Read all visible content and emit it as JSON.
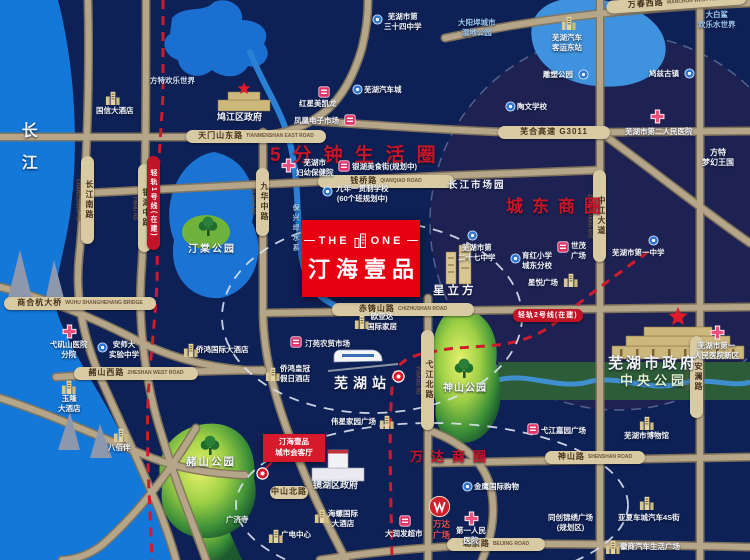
{
  "map": {
    "colors": {
      "background": "#0e2156",
      "water": "#1478d8",
      "road": "#b6a689",
      "capsule": "#d8cba4",
      "accent_red": "#c81528",
      "project_red": "#e60012",
      "metro_red": "#c21426",
      "park_green": "#8cc63f"
    },
    "project": {
      "logo_left": "THE",
      "logo_right": "ONE",
      "name": "汀海壹品"
    },
    "flag": {
      "lines": [
        "汀海壹品",
        "城市会客厅"
      ]
    },
    "pois": [
      {
        "n": "changjiang-river-label",
        "k": "lbl",
        "t": "长江",
        "x": 16,
        "y": 122,
        "s": 16,
        "ls": 16,
        "v": true,
        "c": "#eaf4ff"
      },
      {
        "n": "shanghehang-bridge-capsule",
        "k": "cap",
        "t": "商合杭大桥",
        "en": "WUHU SHANGHEHANG BRIDGE",
        "x": 4,
        "y": 297,
        "w": 152
      },
      {
        "n": "tianmenshan-east-road-capsule",
        "k": "cap",
        "t": "天门山东路",
        "en": "TIANMENSHAN EAST ROAD",
        "x": 186,
        "y": 130,
        "w": 140
      },
      {
        "n": "wanchun-west-road-capsule",
        "k": "cap",
        "t": "万春西路",
        "en": "WANCHUN WEST ROAD",
        "x": 606,
        "y": 1,
        "w": 140,
        "rot": -4
      },
      {
        "n": "qianqiao-road-capsule",
        "k": "cap",
        "t": "钱桥路",
        "en": "QIANQIAO ROAD",
        "x": 318,
        "y": 175,
        "w": 136
      },
      {
        "n": "chizhushan-road-capsule",
        "k": "cap",
        "t": "赤铸山路",
        "en": "CHIZHUSHAN ROAD",
        "x": 332,
        "y": 303,
        "w": 142
      },
      {
        "n": "zheshan-west-road-capsule",
        "k": "cap",
        "t": "赭山西路",
        "en": "ZHESHAN WEST ROAD",
        "x": 74,
        "y": 367,
        "w": 124
      },
      {
        "n": "shenshan-road-capsule",
        "k": "cap",
        "t": "神山路",
        "en": "SHENSHAN ROAD",
        "x": 545,
        "y": 451,
        "w": 100
      },
      {
        "n": "beijing-road-capsule",
        "k": "cap",
        "t": "北京路",
        "en": "BEIJING ROAD",
        "x": 447,
        "y": 538,
        "w": 98
      },
      {
        "n": "wuhe-expressway-capsule",
        "k": "cap",
        "t": "芜合高速 G3011",
        "x": 498,
        "y": 126,
        "w": 112
      },
      {
        "n": "zhongshan-north-road-capsule",
        "k": "cap",
        "t": "中山北路",
        "x": 270,
        "y": 486,
        "w": 38
      },
      {
        "n": "changjiang-south-road-capsule",
        "k": "capv",
        "t": "长江南路",
        "en": "CHANGJIANG RD",
        "x": 81,
        "y": 156,
        "h": 88
      },
      {
        "n": "yinhu-middle-road-capsule",
        "k": "capv",
        "t": "银湖中路",
        "en": "YINHU RD",
        "x": 138,
        "y": 164,
        "h": 88
      },
      {
        "n": "jiuhua-middle-road-capsule",
        "k": "capv",
        "t": "九华中路",
        "en": "JIUHUA RD",
        "x": 256,
        "y": 168,
        "h": 68
      },
      {
        "n": "zhongjiang-avenue-capsule",
        "k": "capv",
        "t": "中江大道",
        "en": "ZHONGJIANG AVE",
        "x": 593,
        "y": 170,
        "h": 92
      },
      {
        "n": "yijiang-north-road-capsule",
        "k": "capv",
        "t": "弋江北路",
        "en": "YIJIANG RD",
        "x": 421,
        "y": 330,
        "h": 100
      },
      {
        "n": "anlan-road-capsule",
        "k": "capv",
        "t": "安澜路",
        "en": "ANLAN RD",
        "x": 690,
        "y": 336,
        "h": 82
      },
      {
        "n": "metro-line1-capsule",
        "k": "metv",
        "t": "轻轨1号线(在建)",
        "x": 147,
        "y": 156,
        "h": 94
      },
      {
        "n": "metro-line2-capsule",
        "k": "met",
        "t": "轻轨2号线(在建)",
        "x": 513,
        "y": 309
      },
      {
        "n": "five-min-life-circle-label",
        "k": "lbl",
        "t": "5分钟生活圈",
        "x": 270,
        "y": 144,
        "s": 19,
        "c": "#c81528",
        "ls": 12
      },
      {
        "n": "chengdong-business-circle-label",
        "k": "lbl",
        "t": "城东商圈",
        "x": 506,
        "y": 196,
        "s": 17,
        "c": "#c81528",
        "ls": 9
      },
      {
        "n": "wanda-business-circle-label",
        "k": "lbl",
        "t": "万达商圈",
        "x": 410,
        "y": 449,
        "s": 13,
        "c": "#c81528",
        "ls": 8
      },
      {
        "n": "jiujiang-district-gov-label",
        "k": "lbl",
        "t": "鸠江区政府",
        "x": 217,
        "y": 112,
        "s": 9
      },
      {
        "n": "fantawild-adventure-label",
        "k": "lbl",
        "t": "方特欢乐世界",
        "x": 150,
        "y": 76,
        "s": 7.5,
        "c": "#cfe0f5"
      },
      {
        "n": "guoxin-hotel-label",
        "k": "lbl",
        "t": "国信大酒店",
        "x": 96,
        "y": 106,
        "s": 7.5
      },
      {
        "n": "guoxin-hotel-icon",
        "k": "bldg",
        "x": 104,
        "y": 88
      },
      {
        "n": "redstar-macalline-label",
        "k": "lbl",
        "t": "红星美凯龙",
        "x": 299,
        "y": 99,
        "s": 7.5
      },
      {
        "n": "redstar-macalline-icon",
        "k": "mkt",
        "x": 318,
        "y": 86
      },
      {
        "n": "phoenix-electronics-market-label",
        "k": "lbl",
        "t": "凤凰电子市场",
        "x": 294,
        "y": 116,
        "s": 7.5
      },
      {
        "n": "phoenix-electronics-market-icon",
        "k": "mkt",
        "x": 344,
        "y": 114
      },
      {
        "n": "wuhu-auto-city-label",
        "k": "lbl",
        "t": "芜湖汽车城",
        "x": 364,
        "y": 85,
        "s": 7.5
      },
      {
        "n": "wuhu-auto-city-icon",
        "k": "badge",
        "x": 352,
        "y": 84
      },
      {
        "n": "no34-middle-school-label",
        "k": "lbl",
        "t": [
          "芜湖市第",
          "三十四中学"
        ],
        "x": 384,
        "y": 12,
        "s": 7.5
      },
      {
        "n": "no34-middle-school-icon",
        "k": "badge",
        "x": 372,
        "y": 14
      },
      {
        "n": "dayanghan-wetland-park-label",
        "k": "lbl",
        "t": [
          "大阳垾城市",
          "湿地公园"
        ],
        "x": 458,
        "y": 18,
        "s": 7.5,
        "c": "#9dc8f0"
      },
      {
        "n": "white-shark-water-park-label",
        "k": "lbl",
        "t": [
          "大白鲨",
          "欢乐水世界"
        ],
        "x": 698,
        "y": 10,
        "s": 7.5,
        "c": "#9dc8f0"
      },
      {
        "n": "coach-east-station-label",
        "k": "lbl",
        "t": [
          "芜湖汽车",
          "客运东站"
        ],
        "x": 552,
        "y": 33,
        "s": 7.5
      },
      {
        "n": "coach-east-station-icon",
        "k": "bldg",
        "x": 560,
        "y": 13
      },
      {
        "n": "sculpture-park-label",
        "k": "lbl",
        "t": "雕塑公园",
        "x": 543,
        "y": 70,
        "s": 7.5
      },
      {
        "n": "sculpture-park-icon",
        "k": "badge",
        "x": 578,
        "y": 69
      },
      {
        "n": "jiuzi-ancient-town-label",
        "k": "lbl",
        "t": "鸠兹古镇",
        "x": 649,
        "y": 69,
        "s": 7.5
      },
      {
        "n": "jiuzi-ancient-town-icon",
        "k": "badge",
        "x": 684,
        "y": 68
      },
      {
        "n": "taowen-school-label",
        "k": "lbl",
        "t": "陶文学校",
        "x": 517,
        "y": 102,
        "s": 7.5
      },
      {
        "n": "taowen-school-icon",
        "k": "badge",
        "x": 505,
        "y": 101
      },
      {
        "n": "no2-peoples-hospital-label",
        "k": "lbl",
        "t": "芜湖市第二人民医院",
        "x": 625,
        "y": 127,
        "s": 7.5
      },
      {
        "n": "no2-peoples-hospital-icon",
        "k": "cross",
        "x": 650,
        "y": 109
      },
      {
        "n": "fuyou-hospital-label",
        "k": "lbl",
        "t": [
          "芜湖市",
          "妇幼保健院"
        ],
        "x": 296,
        "y": 158,
        "s": 7.5
      },
      {
        "n": "fuyou-hospital-icon",
        "k": "cross",
        "x": 281,
        "y": 158
      },
      {
        "n": "yinhu-food-street-label",
        "k": "lbl",
        "t": "银湖美食街(规划中)",
        "x": 352,
        "y": 162,
        "s": 7.5
      },
      {
        "n": "yinhu-food-street-icon",
        "k": "mkt",
        "x": 338,
        "y": 160
      },
      {
        "n": "nine-year-school-label",
        "k": "lbl",
        "t": [
          "九年一贯制学校",
          "(60个班规划中)"
        ],
        "x": 336,
        "y": 184,
        "s": 7.5
      },
      {
        "n": "nine-year-school-icon",
        "k": "badge",
        "x": 322,
        "y": 186
      },
      {
        "n": "baoxinghan-water-label",
        "k": "lbl",
        "t": "保兴垾水系",
        "x": 291,
        "y": 204,
        "s": 7,
        "c": "#a8cdf0",
        "v": true,
        "ls": 3
      },
      {
        "n": "changjiang-market-park-label",
        "k": "lbl",
        "t": "长江市场园",
        "x": 448,
        "y": 180,
        "s": 9.5,
        "ls": 2
      },
      {
        "n": "no27-middle-school-label",
        "k": "lbl",
        "t": [
          "芜湖市第",
          "二十七中学"
        ],
        "x": 458,
        "y": 243,
        "s": 7.5
      },
      {
        "n": "no27-middle-school-icon",
        "k": "badge",
        "x": 467,
        "y": 230
      },
      {
        "n": "xinglifang-label",
        "k": "lbl",
        "t": "星立方",
        "x": 433,
        "y": 284,
        "s": 11.5,
        "ls": 3
      },
      {
        "n": "fantawild-dream-kingdom-label",
        "k": "lbl",
        "t": [
          "方特",
          "梦幻王国"
        ],
        "x": 702,
        "y": 148,
        "s": 8
      },
      {
        "n": "shimao-plaza-label",
        "k": "lbl",
        "t": [
          "世茂",
          "广场"
        ],
        "x": 571,
        "y": 241,
        "s": 7.5
      },
      {
        "n": "shimao-plaza-icon",
        "k": "mkt",
        "x": 557,
        "y": 241
      },
      {
        "n": "no1-middle-school-label",
        "k": "lbl",
        "t": "芜湖市第一中学",
        "x": 612,
        "y": 248,
        "s": 7.5
      },
      {
        "n": "no1-middle-school-icon",
        "k": "badge",
        "x": 648,
        "y": 235
      },
      {
        "n": "yuhong-primary-school-label",
        "k": "lbl",
        "t": [
          "育红小学",
          "城东分校"
        ],
        "x": 522,
        "y": 251,
        "s": 7.5
      },
      {
        "n": "yuhong-primary-school-icon",
        "k": "badge",
        "x": 510,
        "y": 253
      },
      {
        "n": "xingyue-plaza-label",
        "k": "lbl",
        "t": "星悦广场",
        "x": 528,
        "y": 278,
        "s": 7.5
      },
      {
        "n": "xingyue-plaza-icon",
        "k": "bldg",
        "x": 562,
        "y": 270
      },
      {
        "n": "no1-peoples-hospital-label",
        "k": "lbl",
        "t": [
          "芜湖市第一",
          "人民医院新区"
        ],
        "x": 694,
        "y": 341,
        "s": 7.5
      },
      {
        "n": "no1-peoples-hospital-icon",
        "k": "cross",
        "x": 710,
        "y": 325
      },
      {
        "n": "tingyuan-market-label",
        "k": "lbl",
        "t": "汀苑农贸市场",
        "x": 305,
        "y": 339,
        "s": 7.5
      },
      {
        "n": "tingyuan-market-icon",
        "k": "mkt",
        "x": 290,
        "y": 336
      },
      {
        "n": "oyada-home-label",
        "k": "lbl",
        "t": [
          "欧亚达",
          "国际家居"
        ],
        "x": 367,
        "y": 312,
        "s": 7.5
      },
      {
        "n": "oyada-home-icon",
        "k": "bldg",
        "x": 353,
        "y": 312
      },
      {
        "n": "crowne-plaza-hotel-label",
        "k": "lbl",
        "t": [
          "侨鸿皇冠",
          "假日酒店"
        ],
        "x": 280,
        "y": 364,
        "s": 7.5
      },
      {
        "n": "crowne-plaza-hotel-icon",
        "k": "bldg",
        "x": 264,
        "y": 364
      },
      {
        "n": "wuhu-station-label",
        "k": "lbl",
        "t": "芜湖站",
        "x": 334,
        "y": 374,
        "s": 14,
        "ls": 5
      },
      {
        "n": "wuhu-station-metro-icon",
        "k": "dot",
        "x": 392,
        "y": 370
      },
      {
        "n": "qiaohong-intl-hotel-label",
        "k": "lbl",
        "t": "侨鸿国际大酒店",
        "x": 196,
        "y": 345,
        "s": 7.5
      },
      {
        "n": "qiaohong-intl-hotel-icon",
        "k": "bldg",
        "x": 182,
        "y": 340
      },
      {
        "n": "yijishan-hospital-label",
        "k": "lbl",
        "t": [
          "弋矶山医院",
          "分院"
        ],
        "x": 50,
        "y": 340,
        "s": 7.5
      },
      {
        "n": "yijishan-hospital-icon",
        "k": "cross",
        "x": 62,
        "y": 324
      },
      {
        "n": "anshida-school-label",
        "k": "lbl",
        "t": [
          "安师大",
          "实验中学"
        ],
        "x": 109,
        "y": 340,
        "s": 7.5
      },
      {
        "n": "anshida-school-icon",
        "k": "badge",
        "x": 97,
        "y": 342
      },
      {
        "n": "yulong-hotel-label",
        "k": "lbl",
        "t": [
          "玉隆",
          "大酒店"
        ],
        "x": 58,
        "y": 394,
        "s": 7.5
      },
      {
        "n": "yulong-hotel-icon",
        "k": "bldg",
        "x": 60,
        "y": 377
      },
      {
        "n": "weixing-plaza-label",
        "k": "lbl",
        "t": "伟星家园广场",
        "x": 331,
        "y": 417,
        "s": 7.5
      },
      {
        "n": "weixing-plaza-icon",
        "k": "bldg",
        "x": 378,
        "y": 412
      },
      {
        "n": "tingtang-park-label",
        "k": "lbl",
        "t": "汀棠公园",
        "x": 188,
        "y": 243,
        "s": 10,
        "ls": 2
      },
      {
        "n": "tingtang-park-tree-icon",
        "k": "tree",
        "x": 196,
        "y": 216
      },
      {
        "n": "zheshan-park-label",
        "k": "lbl",
        "t": "赭山公园",
        "x": 186,
        "y": 456,
        "s": 10.5,
        "ls": 2
      },
      {
        "n": "zheshan-park-tree-icon",
        "k": "tree",
        "x": 198,
        "y": 435
      },
      {
        "n": "shenshan-park-label",
        "k": "lbl",
        "t": "神山公园",
        "x": 443,
        "y": 382,
        "s": 10,
        "ls": 1
      },
      {
        "n": "shenshan-park-tree-icon",
        "k": "tree",
        "x": 452,
        "y": 358
      },
      {
        "n": "baibaiban-label",
        "k": "lbl",
        "t": "八佰伴",
        "x": 108,
        "y": 443,
        "s": 7.5
      },
      {
        "n": "baibaiban-icon",
        "k": "bldg",
        "x": 112,
        "y": 425
      },
      {
        "n": "guangjisi-temple-label",
        "k": "lbl",
        "t": "广济寺",
        "x": 226,
        "y": 515,
        "s": 7.5
      },
      {
        "n": "jinghu-district-gov-label",
        "k": "lbl",
        "t": "镜湖区政府",
        "x": 313,
        "y": 480,
        "s": 9
      },
      {
        "n": "conch-intl-hotel-label",
        "k": "lbl",
        "t": [
          "海螺国际",
          "大酒店"
        ],
        "x": 328,
        "y": 509,
        "s": 7.5
      },
      {
        "n": "conch-intl-hotel-icon",
        "k": "bldg",
        "x": 313,
        "y": 506
      },
      {
        "n": "radio-tv-center-label",
        "k": "lbl",
        "t": "广电中心",
        "x": 281,
        "y": 530,
        "s": 7.5
      },
      {
        "n": "radio-tv-center-icon",
        "k": "bldg",
        "x": 267,
        "y": 526
      },
      {
        "n": "wanda-plaza-label",
        "k": "lbl",
        "t": [
          "万达",
          "广场"
        ],
        "x": 433,
        "y": 519,
        "s": 8.5,
        "c": "#e65252"
      },
      {
        "n": "wanda-plaza-icon",
        "k": "wanda",
        "x": 428,
        "y": 495
      },
      {
        "n": "no1-hospital-label",
        "k": "lbl",
        "t": [
          "第一人民",
          "医院"
        ],
        "x": 456,
        "y": 526,
        "s": 7.5
      },
      {
        "n": "no1-hospital-icon",
        "k": "cross",
        "x": 464,
        "y": 511
      },
      {
        "n": "rt-mart-label",
        "k": "lbl",
        "t": "大润发超市",
        "x": 385,
        "y": 529,
        "s": 7.5
      },
      {
        "n": "rt-mart-icon",
        "k": "mkt",
        "x": 399,
        "y": 515
      },
      {
        "n": "golden-eagle-label",
        "k": "lbl",
        "t": "金鹰国际购物",
        "x": 474,
        "y": 482,
        "s": 7.5
      },
      {
        "n": "golden-eagle-icon",
        "k": "badge",
        "x": 462,
        "y": 481
      },
      {
        "n": "wuhu-museum-label",
        "k": "lbl",
        "t": "芜湖市博物馆",
        "x": 624,
        "y": 431,
        "s": 7.5
      },
      {
        "n": "wuhu-museum-icon",
        "k": "bldg",
        "x": 638,
        "y": 413
      },
      {
        "n": "yijiang-jiayuan-plaza-label",
        "k": "lbl",
        "t": "弋江嘉园广场",
        "x": 541,
        "y": 426,
        "s": 7.5
      },
      {
        "n": "yijiang-jiayuan-plaza-icon",
        "k": "mkt",
        "x": 527,
        "y": 423
      },
      {
        "n": "tongchuang-plaza-label",
        "k": "lbl",
        "t": [
          "同创锦绣广场",
          "(规划区)"
        ],
        "x": 548,
        "y": 513,
        "s": 7.5
      },
      {
        "n": "yaxia-auto-city-label",
        "k": "lbl",
        "t": "亚夏车城汽车4S街",
        "x": 618,
        "y": 513,
        "s": 7.5
      },
      {
        "n": "yaxia-auto-city-icon",
        "k": "bldg",
        "x": 638,
        "y": 493
      },
      {
        "n": "huishang-auto-plaza-label",
        "k": "lbl",
        "t": "徽商汽车生活广场",
        "x": 620,
        "y": 542,
        "s": 7.5
      },
      {
        "n": "huishang-auto-plaza-icon",
        "k": "bldg",
        "x": 604,
        "y": 537
      },
      {
        "n": "wuhu-city-gov-label",
        "k": "lbl",
        "t": "芜湖市政府",
        "x": 608,
        "y": 354,
        "s": 15,
        "ls": 3
      },
      {
        "n": "central-park-label",
        "k": "lbl",
        "t": "中央公园",
        "x": 620,
        "y": 373,
        "s": 13,
        "ls": 4,
        "c": "#dff0c8"
      },
      {
        "n": "project-hall-dot-icon",
        "k": "dot",
        "x": 256,
        "y": 467
      }
    ]
  }
}
